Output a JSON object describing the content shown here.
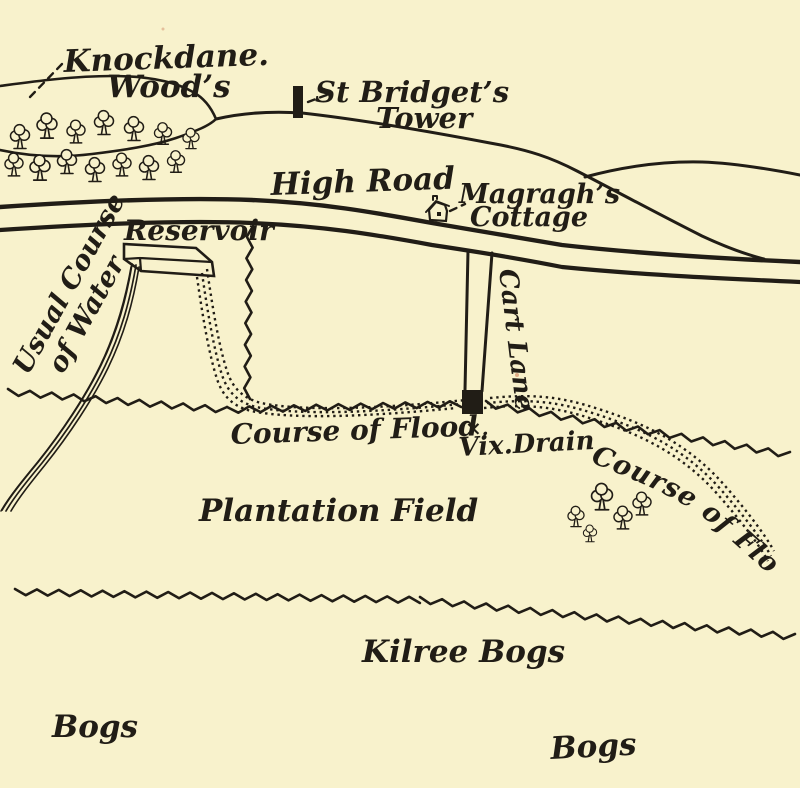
{
  "map": {
    "background_color": "#f8f2cc",
    "ink_color": "#211d16",
    "labels": {
      "knockdane_woods_1": "Knockdane.",
      "knockdane_woods_2": "Wood’s",
      "st_bridgets_1": "St Bridget’s",
      "st_bridgets_2": "Tower",
      "high_road": "High Road",
      "magraghs_1": "Magragh’s",
      "magraghs_2": "Cottage",
      "reservoir": "Reservoir",
      "usual_course_1": "Usual Course",
      "usual_course_2": "of Water",
      "cart_lane": "Cart Lane",
      "course_of_flood_left": "Course of Flood",
      "vix_drain_marker": "×.",
      "vix_drain": "Vix.Drain",
      "course_of_flood_right": "Course of Flood",
      "plantation_field": "Plantation Field",
      "kilree_bogs": "Kilree Bogs",
      "bogs_left": "Bogs",
      "bogs_right": "Bogs"
    }
  }
}
